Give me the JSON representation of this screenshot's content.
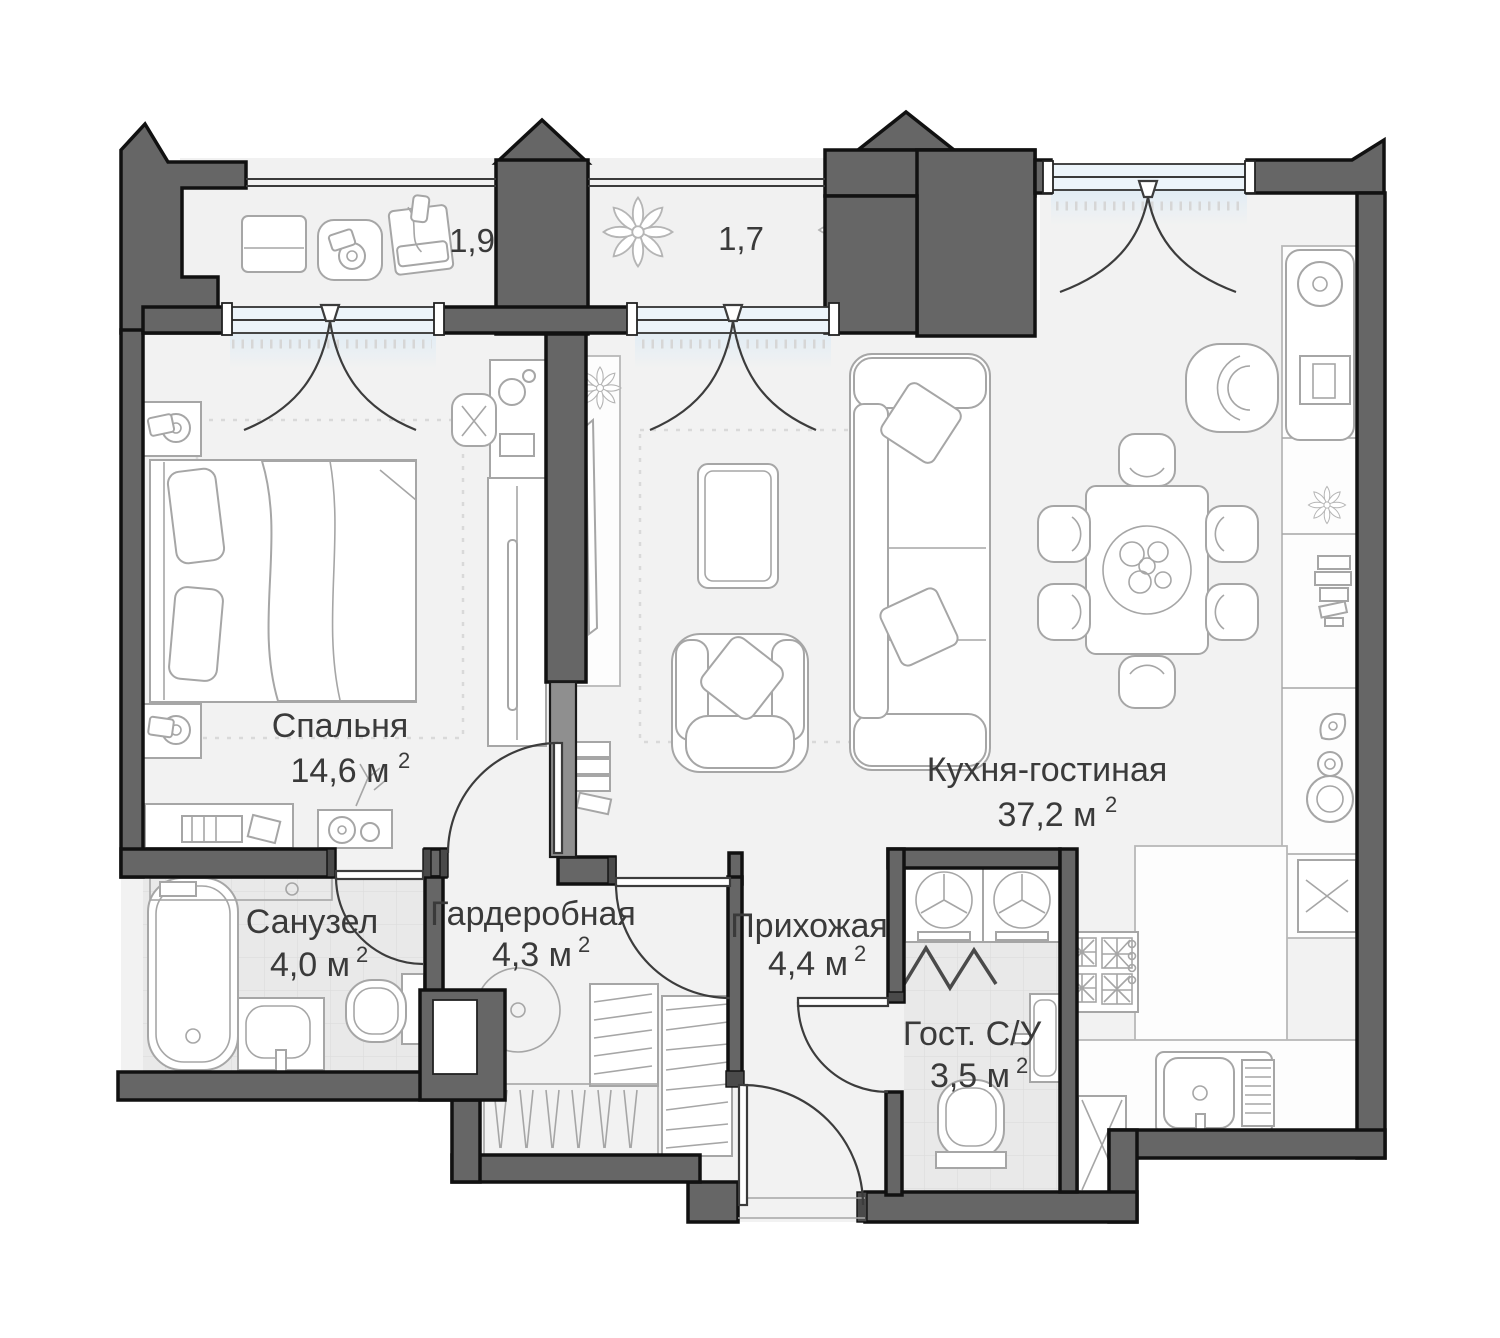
{
  "plan": {
    "type": "apartment-floor-plan",
    "language": "ru",
    "rooms": [
      {
        "name": "Спальня",
        "area": "14,6 м",
        "area_sup": "2"
      },
      {
        "name": "Кухня-гостиная",
        "area": "37,2 м",
        "area_sup": "2"
      },
      {
        "name": "Санузел",
        "area": "4,0 м",
        "area_sup": "2"
      },
      {
        "name": "Гардеробная",
        "area": "4,3 м",
        "area_sup": "2"
      },
      {
        "name": "Прихожая",
        "area": "4,4 м",
        "area_sup": "2"
      },
      {
        "name": "Гост. С/У",
        "area": "3,5 м",
        "area_sup": "2"
      }
    ],
    "balconies": [
      {
        "label": "1,9"
      },
      {
        "label": "1,7"
      }
    ],
    "colors": {
      "wall_fill": "#666666",
      "wall_outline": "#111111",
      "floor": "#f2f2f2",
      "tile_floor": "#e9e9e9",
      "window_glass": "#ecf4fa",
      "furniture_line": "#a6a6a6",
      "label_text": "#3a3a3a"
    }
  }
}
